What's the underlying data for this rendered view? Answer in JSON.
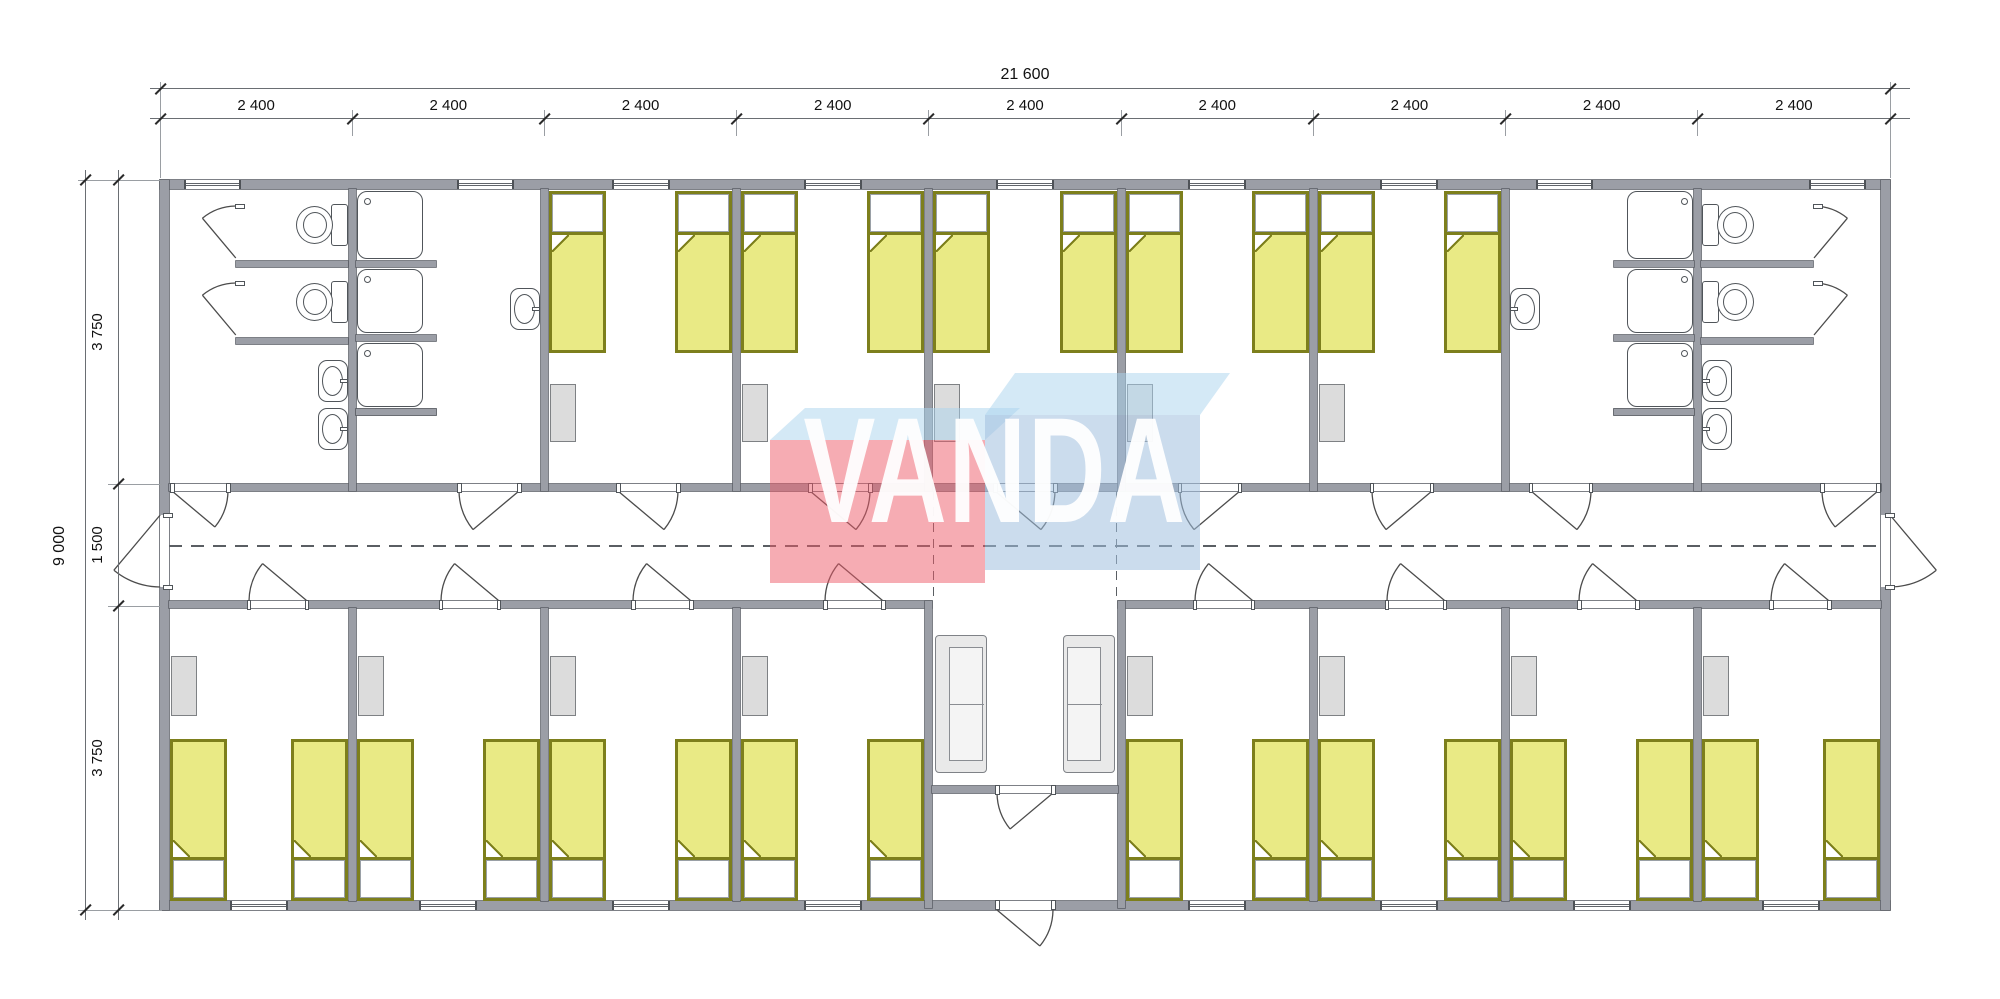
{
  "drawing": {
    "type": "modular-building-floor-plan",
    "style": "architectural-plan"
  },
  "dimensions": {
    "overall_width": "21 600",
    "overall_height": "9 000",
    "top_segments": [
      "2 400",
      "2 400",
      "2 400",
      "2 400",
      "2 400",
      "2 400",
      "2 400",
      "2 400",
      "2 400"
    ],
    "left_segments": [
      "3 750",
      "1 500",
      "3 750"
    ]
  },
  "watermark": {
    "text": "VANDA",
    "red_face": "rgba(238,90,104,0.5)",
    "blue_face": "rgba(160,192,222,0.55)",
    "top_face": "rgba(170,212,238,0.5)",
    "text_color": "#ffffff"
  },
  "building": {
    "modules": 9,
    "corridor": {
      "present": true,
      "center_line": "dashed"
    },
    "top_rooms": [
      {
        "type": "wc",
        "toilets": 2,
        "sinks": 2,
        "stall_doors": 2,
        "mirrored": false
      },
      {
        "type": "shower",
        "showers": 3,
        "sinks": 1,
        "mirrored": false
      },
      {
        "type": "bedroom",
        "beds": 2,
        "wardrobes": 1
      },
      {
        "type": "bedroom",
        "beds": 2,
        "wardrobes": 1
      },
      {
        "type": "bedroom",
        "beds": 2,
        "wardrobes": 1
      },
      {
        "type": "bedroom",
        "beds": 2,
        "wardrobes": 1
      },
      {
        "type": "bedroom",
        "beds": 2,
        "wardrobes": 1
      },
      {
        "type": "shower",
        "showers": 3,
        "sinks": 1,
        "mirrored": true
      },
      {
        "type": "wc",
        "toilets": 2,
        "sinks": 2,
        "stall_doors": 2,
        "mirrored": true
      }
    ],
    "bottom_rooms": [
      {
        "type": "bedroom",
        "beds": 2,
        "wardrobes": 1
      },
      {
        "type": "bedroom",
        "beds": 2,
        "wardrobes": 1
      },
      {
        "type": "bedroom",
        "beds": 2,
        "wardrobes": 1
      },
      {
        "type": "bedroom",
        "beds": 2,
        "wardrobes": 1
      },
      {
        "type": "entry",
        "sofas": 2,
        "entrance_doors": 2
      },
      {
        "type": "bedroom",
        "beds": 2,
        "wardrobes": 1
      },
      {
        "type": "bedroom",
        "beds": 2,
        "wardrobes": 1
      },
      {
        "type": "bedroom",
        "beds": 2,
        "wardrobes": 1
      },
      {
        "type": "bedroom",
        "beds": 2,
        "wardrobes": 1
      }
    ],
    "totals": {
      "beds": 26,
      "wardrobes": 13,
      "toilets": 4,
      "showers": 6,
      "sinks": 6,
      "sofas": 2
    }
  },
  "colors": {
    "wall": "#9b9ea6",
    "wall_outline": "#5d6168",
    "bed_frame": "#7d7f1c",
    "bed_blanket": "#e9ea85",
    "pillow": "#ffffff",
    "wardrobe": "#dcdcdc",
    "fixture_line": "#50555a",
    "dim_text": "#111111"
  }
}
